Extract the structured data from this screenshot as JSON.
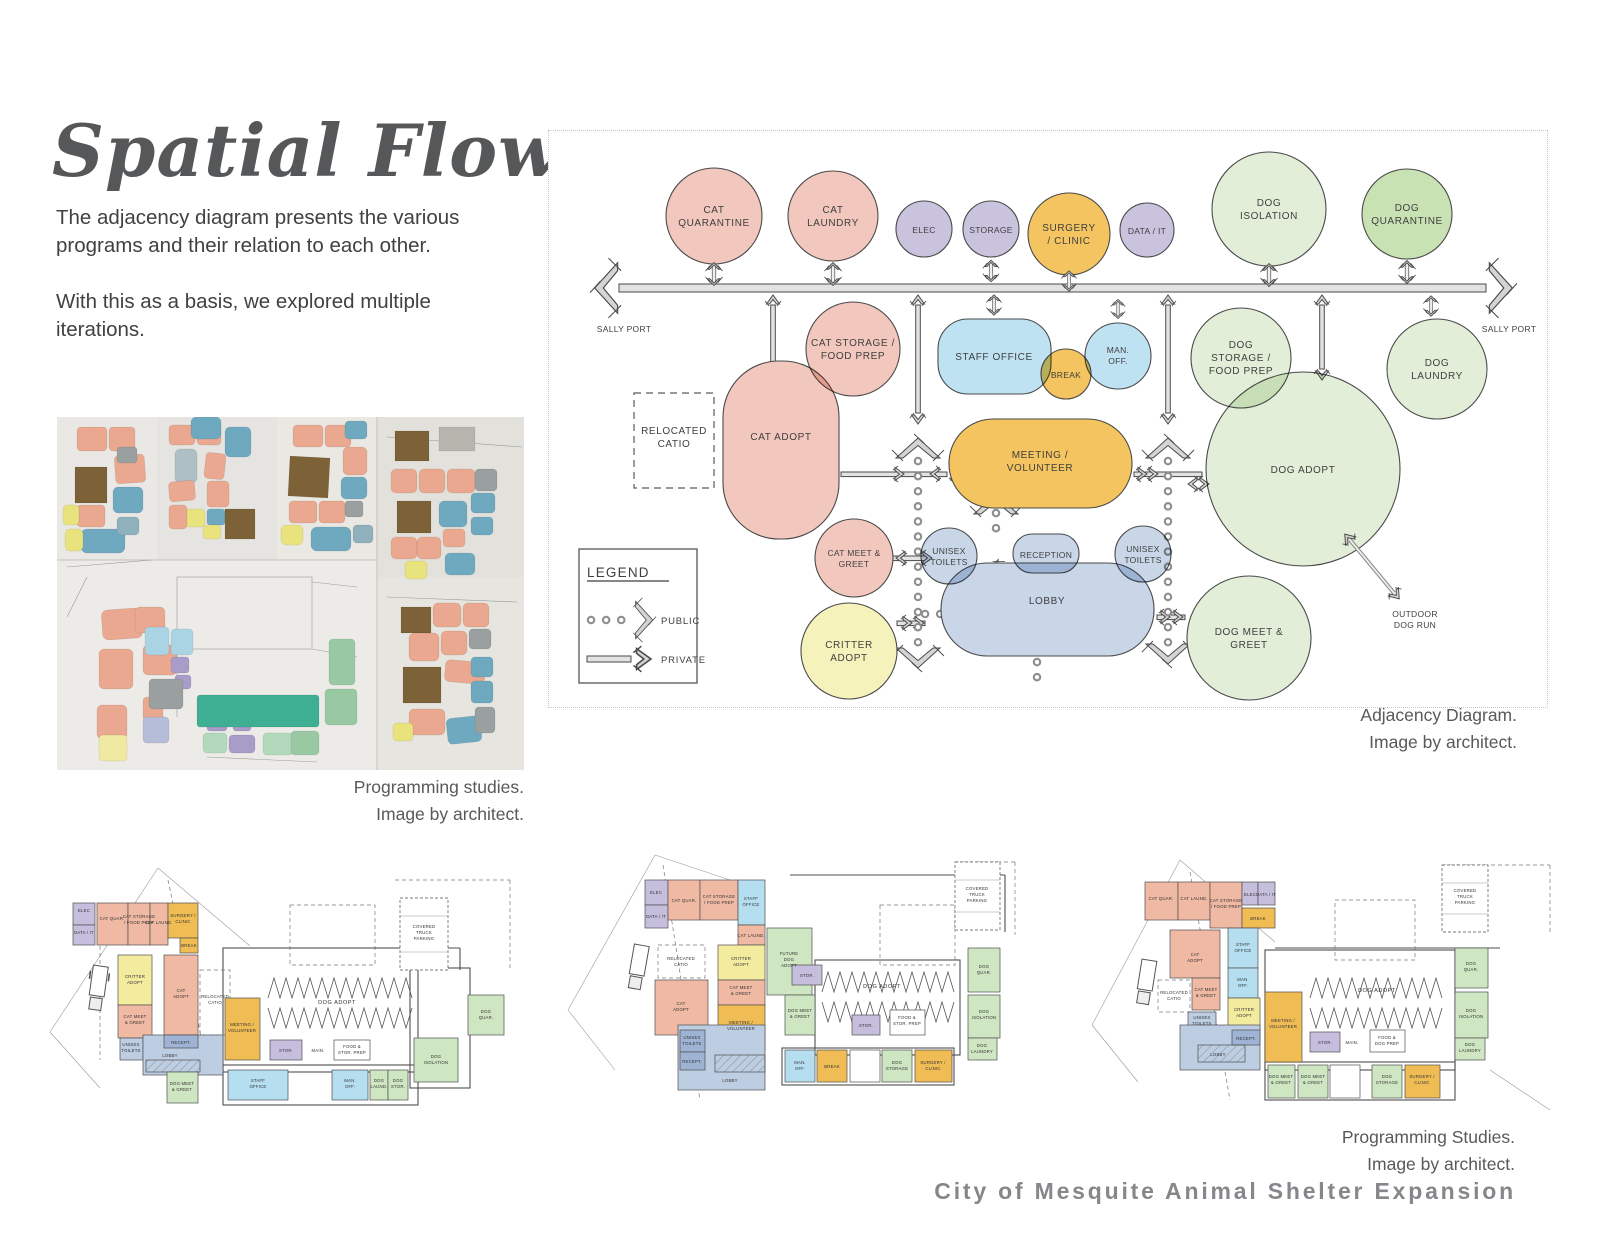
{
  "page": {
    "title": "Spatial Flow",
    "intro1": "The adjacency diagram presents the various programs and their relation to each other.",
    "intro2": "With this as a basis, we explored multiple iterations.",
    "brand": "City of Mesquite Animal Shelter Expansion"
  },
  "captions": {
    "photo": [
      "Programming studies.",
      "Image by architect."
    ],
    "adjacency": [
      "Adjacency Diagram.",
      "Image by architect."
    ],
    "plans": [
      "Programming Studies.",
      "Image by architect."
    ]
  },
  "colors": {
    "salmon": "#f2c7bd",
    "lavender": "#c9c3de",
    "orange": "#f3c45f",
    "light_blue": "#bfe2f2",
    "pale_green": "#e2eed8",
    "green": "#c8e2b4",
    "blue_gray": "#c8d6e8",
    "pale_yellow": "#f6f2bb"
  },
  "adjacency": {
    "legend": {
      "title": "LEGEND",
      "public": "PUBLIC",
      "private": "PRIVATE"
    },
    "sally_port": "SALLY PORT",
    "outdoor_dog_run": [
      "OUTDOOR",
      "DOG RUN"
    ],
    "relocated_catio": [
      "RELOCATED",
      "CATIO"
    ],
    "bubbles": {
      "cat_quarantine": [
        "CAT",
        "QUARANTINE"
      ],
      "cat_laundry": [
        "CAT",
        "LAUNDRY"
      ],
      "elec": [
        "ELEC"
      ],
      "storage": [
        "STORAGE"
      ],
      "surgery_clinic": [
        "SURGERY",
        "/ CLINIC"
      ],
      "data_it": [
        "DATA / IT"
      ],
      "dog_isolation": [
        "DOG",
        "ISOLATION"
      ],
      "dog_quarantine": [
        "DOG",
        "QUARANTINE"
      ],
      "cat_storage_food_prep": [
        "CAT STORAGE /",
        "FOOD PREP"
      ],
      "staff_office": [
        "STAFF OFFICE"
      ],
      "break_room": [
        "BREAK"
      ],
      "manager_office": [
        "MAN.",
        "OFF."
      ],
      "dog_storage_food_prep": [
        "DOG",
        "STORAGE /",
        "FOOD PREP"
      ],
      "dog_laundry": [
        "DOG",
        "LAUNDRY"
      ],
      "cat_adopt": [
        "CAT ADOPT"
      ],
      "meeting_volunteer": [
        "MEETING /",
        "VOLUNTEER"
      ],
      "dog_adopt": [
        "DOG ADOPT"
      ],
      "cat_meet_greet": [
        "CAT MEET &",
        "GREET"
      ],
      "unisex_toilets": [
        "UNISEX",
        "TOILETS"
      ],
      "reception": [
        "RECEPTION"
      ],
      "lobby": [
        "LOBBY"
      ],
      "critter_adopt": [
        "CRITTER",
        "ADOPT"
      ],
      "dog_meet_greet": [
        "DOG MEET &",
        "GREET"
      ]
    }
  },
  "plans": {
    "labels": {
      "elec": "ELEC",
      "data": "DATA / IT",
      "cat_quar": "CAT QUAR.",
      "cat_storage": [
        "CAT STORAGE",
        "/ FOOD PREP"
      ],
      "cat_laund": "CAT LAUND.",
      "surgery": [
        "SURGERY /",
        "CLINIC"
      ],
      "break_room": "BREAK",
      "critter": [
        "CRITTER",
        "ADOPT"
      ],
      "cat_adopt": [
        "CAT",
        "ADOPT"
      ],
      "cat_meet": [
        "CAT MEET",
        "& GREET"
      ],
      "unisex": [
        "UNISEX",
        "TOILETS"
      ],
      "recept": "RECEPT.",
      "lobby": "LOBBY",
      "dog_meet": [
        "DOG MEET",
        "& GREET"
      ],
      "meeting": [
        "MEETING /",
        "VOLUNTEER"
      ],
      "dog_adopt": "DOG ADOPT",
      "stor": "STOR.",
      "main": "MAIN.",
      "food_stor": [
        "FOOD &",
        "STOR. PREP"
      ],
      "food_dog": [
        "FOOD &",
        "DOG PREP"
      ],
      "staff": [
        "STAFF",
        "OFFICE"
      ],
      "man_off": [
        "MAN.",
        "OFF."
      ],
      "dog_laund": [
        "DOG",
        "LAUND."
      ],
      "dog_stor": [
        "DOG",
        "STOR."
      ],
      "dog_storage": [
        "DOG",
        "STORAGE"
      ],
      "dog_laundry": [
        "DOG",
        "LAUNDRY"
      ],
      "dog_iso": [
        "DOG",
        "ISOLATION"
      ],
      "dog_quar": [
        "DOG",
        "QUAR."
      ],
      "parking": [
        "COVERED",
        "TRUCK",
        "PARKING"
      ],
      "catio": [
        "RELOCATED",
        "CATIO"
      ],
      "future": [
        "FUTURE",
        "DOG",
        "ADOPT"
      ]
    }
  }
}
